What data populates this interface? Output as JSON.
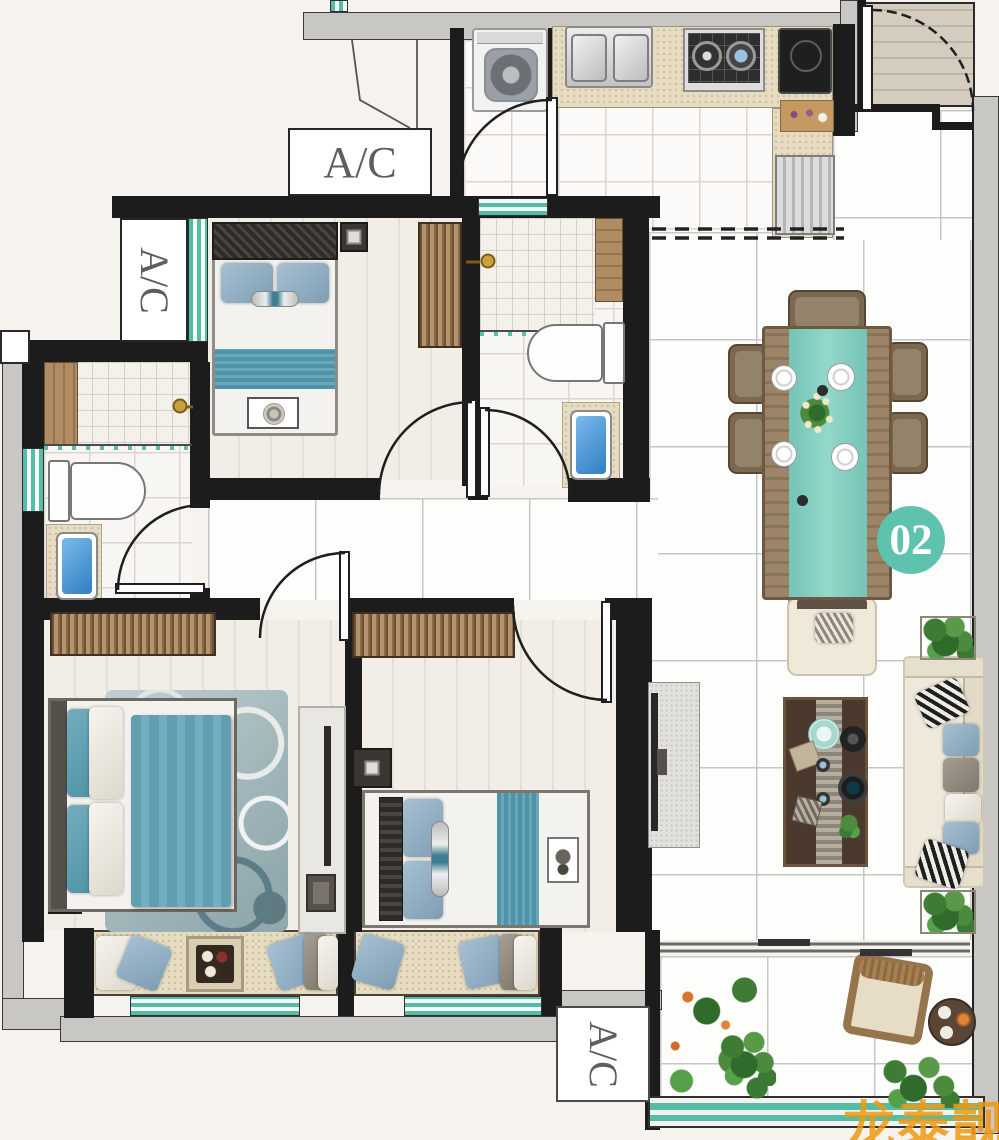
{
  "labels": {
    "ac": "A/C"
  },
  "unit_badge": {
    "number": "02",
    "bg": "#5fc2ae",
    "text_color": "#ffffff"
  },
  "watermark": {
    "text": "龙泰靓房",
    "color": "#ef9913"
  },
  "palette": {
    "wall_black": "#1c1c1c",
    "concrete_gray": "#c8c7c3",
    "window_teal": "#54bda7",
    "counter_beige": "#e5dcc2",
    "furniture_teal": "#5f9fb0",
    "table_runner_teal": "#82cfc0",
    "wood_brown": "#a98c66",
    "floor_white": "#fbfaf8",
    "background": "#f6f3ee"
  }
}
